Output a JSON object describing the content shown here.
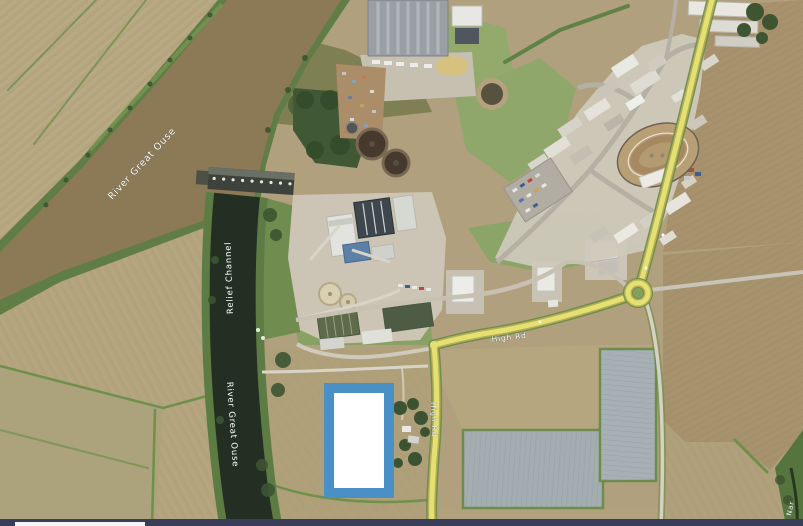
{
  "map": {
    "view": "aerial-satellite",
    "labels": {
      "river_great_ouse_upper": "River Great Ouse",
      "relief_channel": "Relief Channel",
      "river_great_ouse_lower": "River Great Ouse",
      "high_rd_east": "High Rd",
      "high_rd_south": "High Rd",
      "river_nar_partial": "Nar"
    },
    "highlight": {
      "border_color": "#4a90c4",
      "fill_color": "#ffffff"
    },
    "colors": {
      "field_tan": "#b2a07b",
      "river_water_brown": "#8d7a55",
      "channel_water_dark": "#242f24",
      "road_yellow": "#e6e06e",
      "vegetation_green": "#5d7f42",
      "bottom_bar": "#3a3d5a"
    }
  }
}
